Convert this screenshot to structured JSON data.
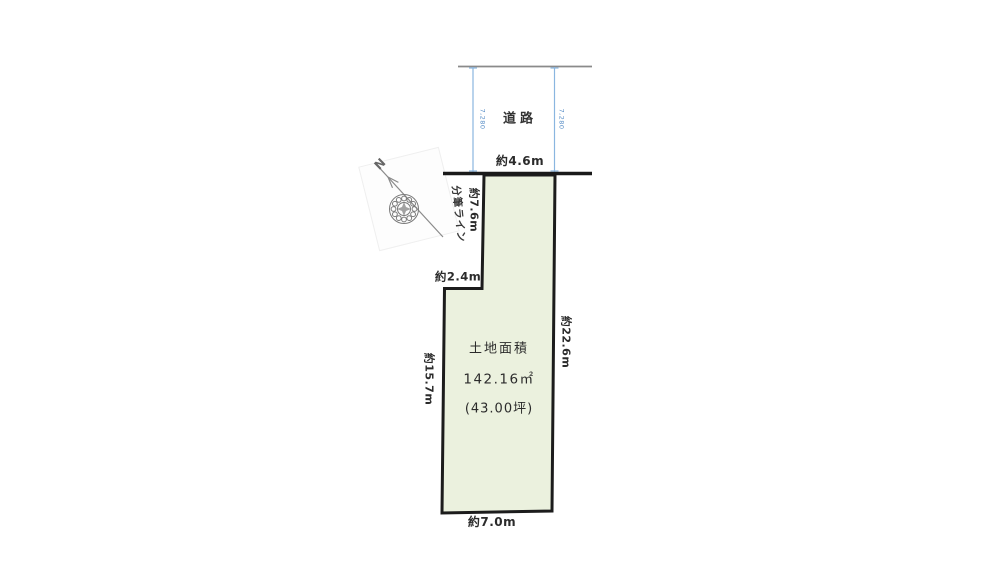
{
  "road": {
    "label": "道路",
    "frontage": "約4.6m",
    "width_dim_left": "7,280",
    "width_dim_right": "7,280"
  },
  "plot": {
    "area_title": "土地面積",
    "area_sqm": "142.16㎡",
    "area_tsubo": "(43.00坪)",
    "dim_upper_left": "約7.6m",
    "dim_step": "約2.4m",
    "dim_left": "約15.7m",
    "dim_right": "約22.6m",
    "dim_bottom": "約7.0m",
    "subdivision_label": "分筆ライン"
  },
  "compass": {
    "north": "N"
  },
  "colors": {
    "background": "#ffffff",
    "plot_fill": "#ebf1de",
    "plot_border": "#1c1c1c",
    "road_edge_line": "#8a8a8a",
    "boundary_line": "#1a1a1a",
    "dim_blue_line": "#8ab6e0",
    "dim_blue_text": "#5a8fc7",
    "label_text": "#2b2b2b",
    "compass_gray": "#7a7a7a"
  }
}
